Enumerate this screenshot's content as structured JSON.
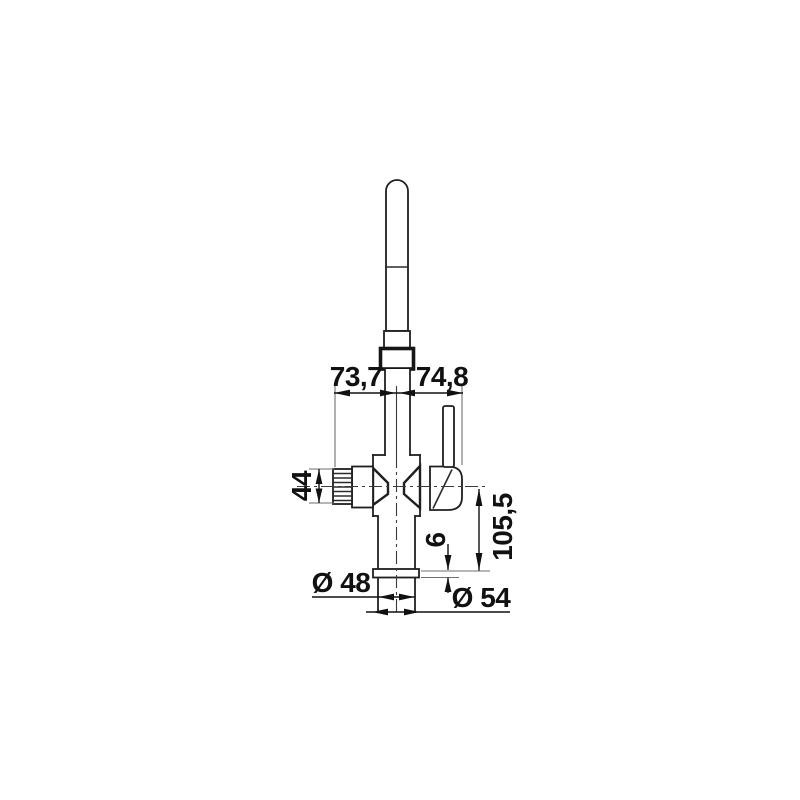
{
  "page": {
    "background": "#ffffff",
    "description": "Technical line drawing of a kitchen mixer tap (front elevation) with dimension annotations"
  },
  "drawing": {
    "colors": {
      "outline": "#1f1f1f",
      "dimension_ink": "#111111",
      "extension_line": "#6e6e6e",
      "centerline": "#3a3a3a",
      "background": "#ffffff"
    },
    "dimensions": {
      "spout_left_offset": "73,7",
      "spout_right_offset": "74,8",
      "knob_height": "44",
      "body_height_below_axis": "105,5",
      "flange_thickness": "6",
      "shaft_diameter": "Ø 48",
      "flange_diameter": "Ø 54"
    }
  }
}
